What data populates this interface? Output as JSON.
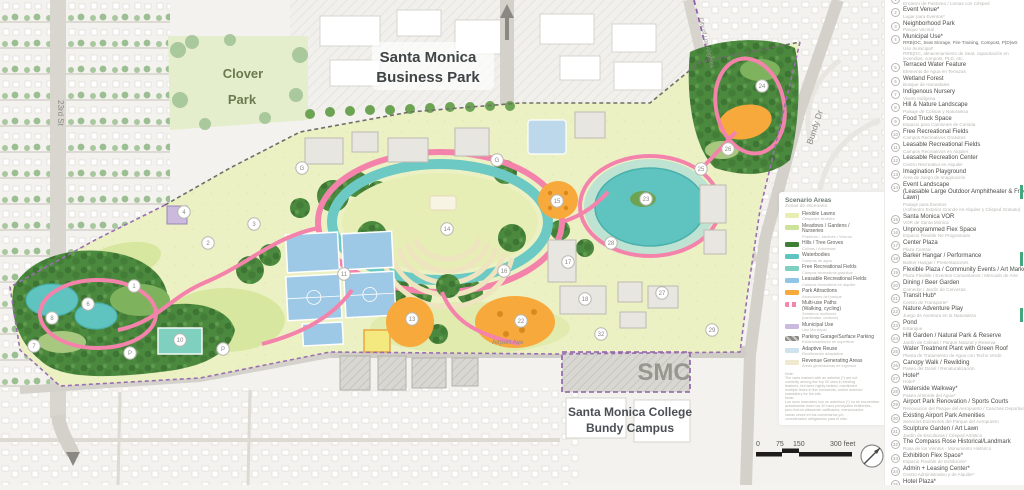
{
  "map": {
    "area_labels": {
      "business_park_1": "Santa Monica",
      "business_park_2": "Business Park",
      "clover_1": "Clover",
      "clover_2": "Park",
      "smc": "SMC",
      "college_1": "Santa Monica College",
      "college_2": "Bundy Campus"
    },
    "street_labels": {
      "street_23rd": "23rd St",
      "bundy": "Bundy Dr",
      "airport_ave": "Airport Ave",
      "city_boundary": "City of Los Angeles"
    },
    "scale": {
      "ticks": [
        "0",
        "75",
        "150",
        "300 feet"
      ]
    },
    "markers": [
      {
        "n": "7",
        "x": 34,
        "y": 346
      },
      {
        "n": "8",
        "x": 52,
        "y": 318
      },
      {
        "n": "6",
        "x": 88,
        "y": 304
      },
      {
        "n": "1",
        "x": 134,
        "y": 286
      },
      {
        "n": "2",
        "x": 208,
        "y": 243
      },
      {
        "n": "4",
        "x": 184,
        "y": 212
      },
      {
        "n": "3",
        "x": 254,
        "y": 224
      },
      {
        "n": "10",
        "x": 180,
        "y": 340
      },
      {
        "n": "11",
        "x": 344,
        "y": 274
      },
      {
        "n": "14",
        "x": 447,
        "y": 229
      },
      {
        "n": "13",
        "x": 412,
        "y": 319
      },
      {
        "n": "16",
        "x": 504,
        "y": 271
      },
      {
        "n": "22",
        "x": 521,
        "y": 321
      },
      {
        "n": "15",
        "x": 557,
        "y": 201
      },
      {
        "n": "17",
        "x": 568,
        "y": 262
      },
      {
        "n": "18",
        "x": 585,
        "y": 299
      },
      {
        "n": "23",
        "x": 646,
        "y": 199
      },
      {
        "n": "28",
        "x": 611,
        "y": 243
      },
      {
        "n": "27",
        "x": 662,
        "y": 293
      },
      {
        "n": "25",
        "x": 701,
        "y": 169
      },
      {
        "n": "26",
        "x": 728,
        "y": 149
      },
      {
        "n": "24",
        "x": 762,
        "y": 86
      },
      {
        "n": "32",
        "x": 601,
        "y": 334
      },
      {
        "n": "29",
        "x": 712,
        "y": 330
      },
      {
        "n": "P",
        "x": 130,
        "y": 353
      },
      {
        "n": "P",
        "x": 223,
        "y": 349
      },
      {
        "n": "G",
        "x": 302,
        "y": 168
      },
      {
        "n": "G",
        "x": 497,
        "y": 160
      }
    ]
  },
  "scenario_legend": {
    "title": "Scenario Areas",
    "subtitle": "Zonas de escenario",
    "items": [
      {
        "label": "Flexible Lawns",
        "sublabel": "Céspedes flexibles",
        "color": "#e8eeb0",
        "variant": "solid"
      },
      {
        "label": "Meadows / Gardens /\nNurseries",
        "sublabel": "Praderas / Jardines / Viveros",
        "color": "#cde29a",
        "variant": "solid"
      },
      {
        "label": "Hills / Tree Groves",
        "sublabel": "Colinas / Arboledas",
        "color": "#3e7e37",
        "variant": "solid"
      },
      {
        "label": "Waterbodies",
        "sublabel": "Cuerpos de agua",
        "color": "#5fc4c0",
        "variant": "solid"
      },
      {
        "label": "Free Recreational Fields",
        "sublabel": "Campos recreativos gratuitos",
        "color": "#7fd0bf",
        "variant": "solid"
      },
      {
        "label": "Leasable Recreational Fields",
        "sublabel": "Campos recreativos en alquiler",
        "color": "#92c4e6",
        "variant": "solid"
      },
      {
        "label": "Park Attractions",
        "sublabel": "Atracciones del parque",
        "color": "#f7a93c",
        "variant": "solid"
      },
      {
        "label": "Multi-use Paths\n(Walking, cycling)",
        "sublabel": "Senderos multiusos\n(caminatas, ciclismo)",
        "color": "#f585ac",
        "variant": "dashes"
      },
      {
        "label": "Municipal Use",
        "sublabel": "Uso Municipal",
        "color": "#cbb9de",
        "variant": "solid"
      },
      {
        "label": "Parking Garage/Surface Parking",
        "sublabel": "Estacionamiento en superficie",
        "color": "#8d8b86",
        "variant": "stripes"
      },
      {
        "label": "Adaptive Reuse",
        "sublabel": "Reutilización adaptativa",
        "color": "#cfe2ee",
        "variant": "solid"
      },
      {
        "label": "Revenue Generating Areas",
        "sublabel": "Áreas generadoras de ingresos",
        "color": "#efe9cf",
        "variant": "solid"
      }
    ],
    "note": "Note:\nThe uses marked with an asterisk (*) are not\ncurrently among the top 30 uses in existing\nfeatures, but were highly ranked, mentioned\nmultiple times in the comments, and/or deemed\nmandatory for the site.\nNota:\nLos usos marcados con un asterisco (*) no se encuentran\nactualmente entre los 30 usos principales existentes,\npero fueron altamente calificados, mencionados\nvarias veces en los comentarios y/o\nconsiderados obligatorios para el sitio."
  },
  "legend": {
    "items": [
      {
        "num": "1",
        "label": "Grazing Enclosure / Knolls",
        "subs": [
          "Encierro de Pastoreo / Lomas con Césped"
        ]
      },
      {
        "num": "2",
        "label": "Event Venue*",
        "subs": [
          "Lugar para Eventos*"
        ]
      },
      {
        "num": "3",
        "label": "Neighborhood Park",
        "subs": [
          "Parque Vecinal"
        ]
      },
      {
        "num": "4",
        "label": "Municipal Use*",
        "subs_dark": [
          "RRB|OC, Seat Storage, Fire Training, Compost, P(D)wtr."
        ],
        "subs": [
          "Uso municipal*",
          "RRB|OC, almacenamiento de Seat, capacitación en\nincendios, compost, PLD, etc."
        ]
      },
      {
        "num": "5",
        "label": "Terraced Water Feature",
        "subs": [
          "Elemento de Agua en Terrazas"
        ]
      },
      {
        "num": "6",
        "label": "Wetland Forest",
        "subs": [
          "Bosque de Humedales"
        ]
      },
      {
        "num": "7",
        "label": "Indigenous Nursery",
        "subs": [
          "Vivero Indígena"
        ]
      },
      {
        "num": "8",
        "label": "Hill & Nature Landscape",
        "subs": [
          "Paisaje de Colinas y Naturaleza"
        ]
      },
      {
        "num": "9",
        "label": "Food Truck Space",
        "subs": [
          "Espacio para Camiones de Comida"
        ]
      },
      {
        "num": "10",
        "label": "Free Recreational Fields",
        "subs": [
          "Campos Recreativos Gratuitos"
        ]
      },
      {
        "num": "11",
        "label": "Leasable Recreational Fields",
        "subs": [
          "Campos Recreativos en Alquiler"
        ]
      },
      {
        "num": "12",
        "label": "Leasable Recreation Center",
        "subs": [
          "Centro Recreativo en Alquiler"
        ]
      },
      {
        "num": "13",
        "label": "Imagination Playground",
        "subs": [
          "Área de Juego de Imaginación"
        ]
      },
      {
        "num": "14",
        "label": "Event Landscape\n(Leasable Large Outdoor Amphitheater & Free Lawn)",
        "subs": [
          "Paisaje para Eventos\n(Anfiteatro Exterior Grande en Alquiler y Césped Gratuito)"
        ]
      },
      {
        "num": "15",
        "label": "Santa Monica VOR",
        "subs": [
          "VOR de Santa Mónica"
        ]
      },
      {
        "num": "16",
        "label": "Unprogrammed Flex Space",
        "subs": [
          "Espacio Flexible No Programado"
        ]
      },
      {
        "num": "17",
        "label": "Center Plaza",
        "subs": [
          "Plaza Central"
        ]
      },
      {
        "num": "18",
        "label": "Barker Hangar / Performance",
        "subs": [
          "Barker Hangar / Presentaciones"
        ]
      },
      {
        "num": "19",
        "label": "Flexible Plaza / Community Events / Art Market",
        "subs": [
          "Plaza Flexible / Eventos Comunitarios / Mercado de Arte"
        ]
      },
      {
        "num": "20",
        "label": "Dining / Beer Garden",
        "subs": [
          "Comedor / Jardín de Cervezas"
        ]
      },
      {
        "num": "21",
        "label": "Transit Hub*",
        "subs": [
          "Centro de Transporte*"
        ]
      },
      {
        "num": "22",
        "label": "Nature Adventure Play",
        "subs": [
          "Juego de Aventura en la Naturaleza"
        ]
      },
      {
        "num": "23",
        "label": "Pond",
        "subs": [
          "Estanque"
        ]
      },
      {
        "num": "24",
        "label": "Hill Garden / Natural Park & Reserve",
        "subs": [
          "Jardín de Colinas / Parque Natural y Reserva"
        ]
      },
      {
        "num": "25",
        "label": "Water Treatment Plant with Green Roof",
        "subs": [
          "Planta de Tratamiento de Agua con Techo Verde"
        ]
      },
      {
        "num": "26",
        "label": "Canopy Walk / Rewilding",
        "subs": [
          "Paseo del Dosel / Renaturalización"
        ]
      },
      {
        "num": "27",
        "label": "Hotel*",
        "subs": [
          "Hotel*"
        ]
      },
      {
        "num": "28",
        "label": "Waterside Walkway*",
        "subs": [
          "Paseo al Borde del Agua*"
        ]
      },
      {
        "num": "29",
        "label": "Airport Park Renovation / Sports Courts",
        "subs": [
          "Renovación del Parque del Aeropuerto / Canchas Deportivas"
        ]
      },
      {
        "num": "30",
        "label": "Existing Airport Park Amenities",
        "subs": [
          "Servicios Existentes del Parque del Aeropuerto"
        ]
      },
      {
        "num": "31",
        "label": "Sculpture Garden / Art Lawn",
        "subs": [
          "Jardín de Esculturas / Césped Artístico"
        ]
      },
      {
        "num": "32",
        "label": "The Compass Rose Historical/Landmark",
        "subs": [
          "Rosa de los Vientos - Monumento Histórico"
        ]
      },
      {
        "num": "33",
        "label": "Exhibition Flex Space*",
        "subs": [
          "Espacio Flexible de Exhibición*"
        ]
      },
      {
        "num": "34",
        "label": "Admin + Leasing Center*",
        "subs": [
          "Centro Administrativo y de Alquiler*"
        ]
      },
      {
        "num": "35",
        "label": "Hotel Plaza*",
        "subs": [
          "Plaza del Hotel*"
        ]
      }
    ]
  }
}
